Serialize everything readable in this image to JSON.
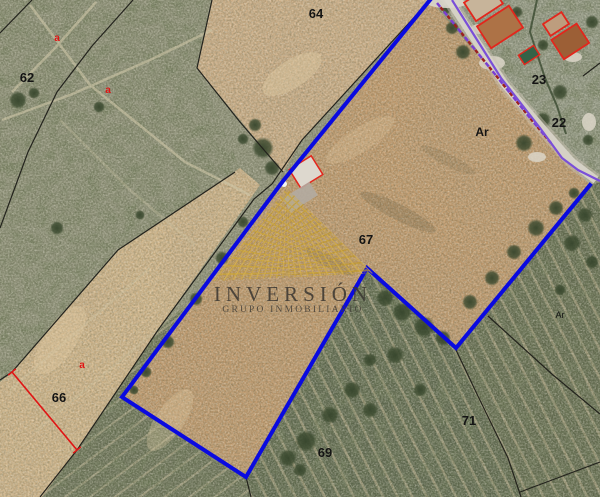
{
  "watermark": {
    "title": "INVERSIÓN",
    "subtitle": "GRUPO INMOBILIARIO"
  },
  "parcel_labels": [
    {
      "id": "62",
      "text": "62"
    },
    {
      "id": "64",
      "text": "64"
    },
    {
      "id": "23",
      "text": "23"
    },
    {
      "id": "22",
      "text": "22"
    },
    {
      "id": "ar-large",
      "text": "Ar"
    },
    {
      "id": "ar-small",
      "text": "Ar"
    },
    {
      "id": "67",
      "text": "67"
    },
    {
      "id": "66",
      "text": "66"
    },
    {
      "id": "69",
      "text": "69"
    },
    {
      "id": "71",
      "text": "71"
    }
  ],
  "subparcel_marks": [
    {
      "id": "a-1",
      "text": "a"
    },
    {
      "id": "a-2",
      "text": "a"
    },
    {
      "id": "a-3",
      "text": "a"
    }
  ],
  "colors": {
    "property_boundary": "#0a0ae0",
    "cadastral_line": "#23231d",
    "road_line": "#7a4fd8",
    "dash_alt_red": "#9c2020",
    "building_outline": "#e3261c",
    "measure_line": "#e01414",
    "watermark_gold": "#c8a43c",
    "pool_green": "#356247"
  }
}
